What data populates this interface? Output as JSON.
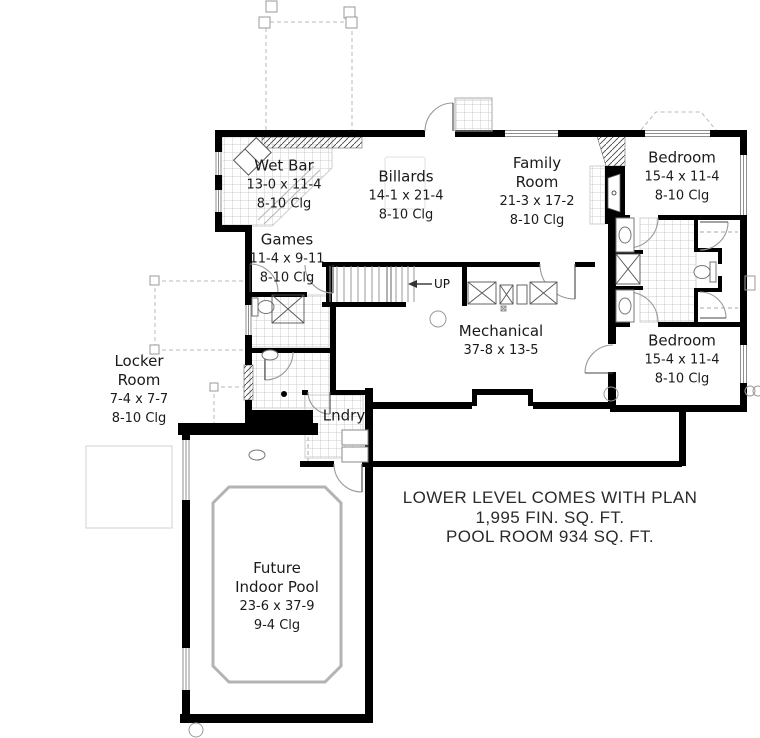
{
  "plan_title": "Lower Level Floor Plan",
  "rooms": {
    "wet_bar": {
      "name": "Wet Bar",
      "dims": "13-0 x 11-4",
      "clg": "8-10 Clg"
    },
    "billards": {
      "name": "Billards",
      "dims": "14-1 x 21-4",
      "clg": "8-10 Clg"
    },
    "family": {
      "name": "Family\nRoom",
      "dims": "21-3 x 17-2",
      "clg": "8-10 Clg"
    },
    "bedroom_top": {
      "name": "Bedroom",
      "dims": "15-4 x 11-4",
      "clg": "8-10 Clg"
    },
    "games": {
      "name": "Games",
      "dims": "11-4 x 9-11",
      "clg": "8-10 Clg"
    },
    "mechanical": {
      "name": "Mechanical",
      "dims": "37-8 x 13-5"
    },
    "bedroom_bottom": {
      "name": "Bedroom",
      "dims": "15-4 x 11-4",
      "clg": "8-10 Clg"
    },
    "locker": {
      "name": "Locker\nRoom",
      "dims": "7-4 x 7-7",
      "clg": "8-10 Clg"
    },
    "laundry": {
      "name": "Lndry"
    },
    "pool": {
      "name": "Future\nIndoor Pool",
      "dims": "23-6 x 37-9",
      "clg": "9-4 Clg"
    }
  },
  "stairs": {
    "up_label": "UP"
  },
  "notes": {
    "line1": "LOWER LEVEL COMES WITH PLAN",
    "line2": "1,995 FIN. SQ. FT.",
    "line3": "POOL ROOM 934 SQ. FT."
  },
  "colors": {
    "wall": "#000000",
    "thin_line": "#999999",
    "tile_line": "#cccccc",
    "pool_outline": "#b3b3b3",
    "text": "#1a1a1a"
  }
}
